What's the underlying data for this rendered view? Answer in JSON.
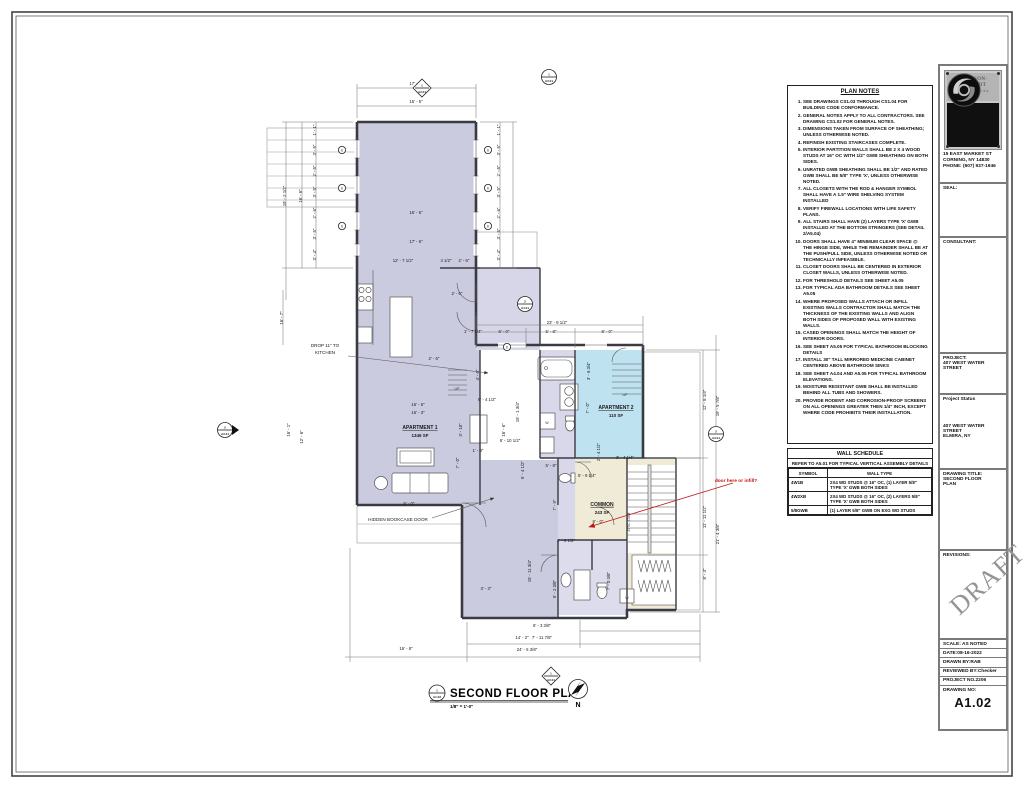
{
  "sheet": {
    "firm_name_line1": "JOHNSON-",
    "firm_name_line2": "SCHMIDT",
    "firm_sub": "ARCHITECTS",
    "firm_sub2": "PC",
    "address_line1": "15 EAST MARKET ST",
    "address_line2": "CORNING, NY 14830",
    "address_line3": "PHONE: (607) 937-1946",
    "seal_label": "SEAL:",
    "consultant_label": "CONSULTANT:",
    "project_label": "PROJECT:",
    "project_name": "407 WEST WATER STREET",
    "status_label": "Project Status",
    "project_address_line1": "407 WEST WATER",
    "project_address_line2": "STREET",
    "project_address_line3": "ELMIRA, NY",
    "drawing_title_label": "DRAWING TITLE:",
    "drawing_title_line1": "SECOND FLOOR",
    "drawing_title_line2": "PLAN",
    "revisions_label": "REVISIONS:",
    "draft_watermark": "DRAFT",
    "scale": "SCALE: AS NOTED",
    "date": "DATE:08-16-2022",
    "drawn_by": "DRAWN BY:RAB",
    "reviewed_by": "REVIEWED BY:Checker",
    "project_no": "PROJECT NO.2206",
    "drawing_no_label": "DRAWING NO:",
    "drawing_no": "A1.02"
  },
  "plan_notes": {
    "title": "PLAN NOTES",
    "items": [
      "SEE DRAWINGS CS1.03 THROUGH CS1.04 FOR BUILDING CODE CONFORMANCE.",
      "GENERAL NOTES APPLY TO ALL CONTRACTORS. SEE DRAWING CS1.02 FOR GENERAL NOTES.",
      "DIMENSIONS TAKEN FROM SURFACE OF SHEATHING; UNLESS OTHERWISE NOTED.",
      "REFINISH EXISTING STAIRCASES COMPLETE.",
      "INTERIOR PARTITION WALLS SHALL BE 2 X 4 WOOD STUDS AT 16\" OC WITH 1/2\" GWB SHEATHING ON BOTH SIDES.",
      "UNRATED GWB SHEATHING SHALL BE 1/2\" AND RATED GWB SHALL BE 5/8\" TYPE 'X', UNLESS OTHERWISE NOTED.",
      "ALL CLOSETS WITH THE ROD & HANGER SYMBOL SHALL HAVE A 1.5\" WIRE SHELVING SYSTEM INSTALLED",
      "VERIFY FIREWALL LOCATIONS WITH LIFE SAFETY PLANS.",
      "ALL STAIRS SHALL HAVE (2) LAYERS TYPE 'X' GWB INSTALLED AT THE BOTTOM STRINGERS (SEE DETAIL 2/A5.04)",
      "DOORS SHALL HAVE 4\" MINIMUM CLEAR SPACE @ THE HINGE SIDE, WHILE THE REMAINDER SHALL BE AT THE PUSH/PULL SIDE, UNLESS OTHERWISE NOTED OR TECHNICALLY INFEASIBLE.",
      "CLOSET DOORS SHALL BE CENTERED IN EXTERIOR CLOSET WALLS, UNLESS OTHERWISE NOTED.",
      "FOR THRESHOLD DETAILS SEE SHEET A5.05",
      "FOR TYPICAL ADA BATHROOM DETAILS SEE SHEET A5.05",
      "WHERE PROPOSED WALLS ATTACH OR INFILL EXISTING WALLS CONTRACTOR SHALL MATCH THE THICKNESS OF THE EXISTING WALLS AND ALIGN BOTH SIDES OF PROPOSED WALL WITH EXISTING WALLS.",
      "CASED OPENINGS SHALL MATCH THE HEIGHT OF INTERIOR DOORS.",
      "SEE SHEET A5.05 FOR TYPICAL BATHROOM BLOCKING DETAILS",
      "INSTALL 30\" TALL MIRRORED MEDICINE CABINET CENTERED ABOVE BATHROOM SINKS",
      "SEE SHEET A4.04 AND A5.05 FOR TYPICAL BATHROOM ELEVATIONS.",
      "MOISTURE RESISTANT GWB SHALL BE INSTALLED BEHIND ALL TUBS AND SHOWERS.",
      "PROVIDE RODENT AND CORROSION-PROOF SCREENS ON ALL OPENINGS GREATER THEN 1/4\" INCH, EXCEPT WHERE CODE PROHIBITS THEIR INSTALLATION."
    ]
  },
  "wall_schedule": {
    "title": "WALL SCHEDULE",
    "subtitle": "REFER TO A5.01 FOR TYPICAL VERTICAL ASSEMBLY DETAILS",
    "col_symbol": "SYMBOL",
    "col_walltype": "WALL TYPE",
    "rows": [
      {
        "symbol": "4W1B",
        "wall_type": "2X4 WD STUDS @ 16\" OC, (1) LAYER 5/8\" TYPE 'X' GWB BOTH SIDES"
      },
      {
        "symbol": "4W2XB",
        "wall_type": "2X4 WD STUDS @ 16\" OC, (2) LAYERS 5/8\" TYPE 'X' GWB BOTH SIDES"
      },
      {
        "symbol": "5/8GWB",
        "wall_type": "(1) LAYER 5/8\" GWB ON EXG WD STUDS"
      }
    ]
  },
  "plan_title": {
    "num": "1",
    "sheet": "A1.02",
    "title": "SECOND FLOOR PLAN",
    "scale": "1/8\" = 1'-0\"",
    "north": "N"
  },
  "rooms": [
    {
      "name": "APARTMENT 1",
      "area": "1346 SF"
    },
    {
      "name": "APARTMENT 2",
      "area": "110 SF"
    },
    {
      "name": "COMMON",
      "area": "243 SF"
    }
  ],
  "colors": {
    "room_lavender": "#cbcbe0",
    "room_blue": "#bfe2f1",
    "room_cream": "#f0ebd7",
    "wall": "#3a3a42",
    "redline": "#c11515"
  },
  "plan": {
    "texts": [
      {
        "x": 416,
        "y": 85,
        "t": "17' - 6\""
      },
      {
        "x": 416,
        "y": 103,
        "t": "16' - 5\""
      },
      {
        "x": 416,
        "y": 214,
        "t": "16' - 5\""
      },
      {
        "x": 416,
        "y": 243,
        "t": "17' - 6\""
      },
      {
        "x": 403,
        "y": 262,
        "t": "12' - 7 1/2\""
      },
      {
        "x": 446,
        "y": 262,
        "t": "4 1/2\""
      },
      {
        "x": 464,
        "y": 262,
        "t": "2' - 6\""
      },
      {
        "x": 286,
        "y": 196,
        "t": "19' - 2 1/2\"",
        "r": -90
      },
      {
        "x": 302,
        "y": 196,
        "t": "16' - 6\"",
        "r": -90
      },
      {
        "x": 316,
        "y": 130,
        "t": "1' - 1\"",
        "r": -90
      },
      {
        "x": 316,
        "y": 150,
        "t": "3' - 5\"",
        "r": -90
      },
      {
        "x": 316,
        "y": 171,
        "t": "2' - 6\"",
        "r": -90
      },
      {
        "x": 316,
        "y": 192,
        "t": "3' - 5\"",
        "r": -90
      },
      {
        "x": 316,
        "y": 213,
        "t": "2' - 6\"",
        "r": -90
      },
      {
        "x": 316,
        "y": 234,
        "t": "3' - 5\"",
        "r": -90
      },
      {
        "x": 316,
        "y": 255,
        "t": "3' - 4\"",
        "r": -90
      },
      {
        "x": 500,
        "y": 130,
        "t": "1' - 1\"",
        "r": -90
      },
      {
        "x": 500,
        "y": 150,
        "t": "3' - 5\"",
        "r": -90
      },
      {
        "x": 500,
        "y": 171,
        "t": "2' - 6\"",
        "r": -90
      },
      {
        "x": 500,
        "y": 192,
        "t": "3' - 5\"",
        "r": -90
      },
      {
        "x": 500,
        "y": 213,
        "t": "2' - 6\"",
        "r": -90
      },
      {
        "x": 500,
        "y": 234,
        "t": "3' - 5\"",
        "r": -90
      },
      {
        "x": 500,
        "y": 255,
        "t": "3' - 4\"",
        "r": -90
      },
      {
        "x": 283,
        "y": 318,
        "t": "16' - 7\"",
        "r": -90
      },
      {
        "x": 290,
        "y": 430,
        "t": "16' - 1\"",
        "r": -90
      },
      {
        "x": 303,
        "y": 437,
        "t": "12' - 6\"",
        "r": -90
      },
      {
        "x": 457,
        "y": 295,
        "t": "2' - 6\""
      },
      {
        "x": 434,
        "y": 360,
        "t": "2' - 6\""
      },
      {
        "x": 418,
        "y": 406,
        "t": "16' - 6\""
      },
      {
        "x": 418,
        "y": 414,
        "t": "16' - 3\""
      },
      {
        "x": 462,
        "y": 430,
        "t": "3' - 10\"",
        "r": -90
      },
      {
        "x": 459,
        "y": 463,
        "t": "7' - 0\"",
        "r": -90
      },
      {
        "x": 478,
        "y": 452,
        "t": "1' - 9\""
      },
      {
        "x": 487,
        "y": 401,
        "t": "8' - 4 1/2\""
      },
      {
        "x": 479,
        "y": 375,
        "t": "4' - 6\"",
        "r": -90
      },
      {
        "x": 505,
        "y": 430,
        "t": "16' - 6\"",
        "r": -90
      },
      {
        "x": 519,
        "y": 412,
        "t": "15' - 1 3/4\"",
        "r": -90
      },
      {
        "x": 510,
        "y": 442,
        "t": "6' - 10 1/2\""
      },
      {
        "x": 524,
        "y": 470,
        "t": "5' - 4 1/2\"",
        "r": -90
      },
      {
        "x": 409,
        "y": 505,
        "t": "5' - 0\""
      },
      {
        "x": 557,
        "y": 324,
        "t": "23' - 9 1/2\""
      },
      {
        "x": 473,
        "y": 333,
        "t": "1' - 7 1/4\""
      },
      {
        "x": 504,
        "y": 333,
        "t": "6' - 0\""
      },
      {
        "x": 551,
        "y": 333,
        "t": "5' - 8\""
      },
      {
        "x": 607,
        "y": 333,
        "t": "8' - 0\""
      },
      {
        "x": 590,
        "y": 371,
        "t": "3' - 6 3/4\"",
        "r": -90
      },
      {
        "x": 589,
        "y": 408,
        "t": "7' - 0\"",
        "r": -90
      },
      {
        "x": 625,
        "y": 459,
        "t": "3' - 4 1/4\""
      },
      {
        "x": 600,
        "y": 452,
        "t": "2' - 4 1/2\"",
        "r": -90
      },
      {
        "x": 587,
        "y": 477,
        "t": "5' - 9 1/4\""
      },
      {
        "x": 551,
        "y": 467,
        "t": "5' - 8\""
      },
      {
        "x": 556,
        "y": 505,
        "t": "7' - 9\"",
        "r": -90
      },
      {
        "x": 598,
        "y": 523,
        "t": "8' - 0\""
      },
      {
        "x": 566,
        "y": 542,
        "t": "1' - 9 1/2\""
      },
      {
        "x": 531,
        "y": 571,
        "t": "15' - 11 3/4\"",
        "r": -90
      },
      {
        "x": 556,
        "y": 589,
        "t": "5' - 2 3/8\"",
        "r": -90
      },
      {
        "x": 610,
        "y": 581,
        "t": "7' - 0 3/8\"",
        "r": -90
      },
      {
        "x": 486,
        "y": 590,
        "t": "3' - 3\""
      },
      {
        "x": 406,
        "y": 650,
        "t": "16' - 8\""
      },
      {
        "x": 522,
        "y": 639,
        "t": "14' - 2\""
      },
      {
        "x": 527,
        "y": 651,
        "t": "24' - 6 3/8\""
      },
      {
        "x": 542,
        "y": 627,
        "t": "6' - 3 3/8\""
      },
      {
        "x": 542,
        "y": 639,
        "t": "7' - 11 7/8\""
      },
      {
        "x": 706,
        "y": 517,
        "t": "11' - 11 1/2\"",
        "r": -90
      },
      {
        "x": 719,
        "y": 534,
        "t": "21' - 4 3/8\"",
        "r": -90
      },
      {
        "x": 706,
        "y": 574,
        "t": "8' - 4\"",
        "r": -90
      },
      {
        "x": 706,
        "y": 400,
        "t": "12' - 8 1/4\"",
        "r": -90
      },
      {
        "x": 719,
        "y": 406,
        "t": "19' - 5 7/8\"",
        "r": -90
      },
      {
        "x": 420,
        "y": 429,
        "t": "APARTMENT 1",
        "cls": "room"
      },
      {
        "x": 420,
        "y": 437,
        "t": "1346 SF",
        "cls": "area"
      },
      {
        "x": 616,
        "y": 409,
        "t": "APARTMENT 2",
        "cls": "room"
      },
      {
        "x": 616,
        "y": 417,
        "t": "110 SF",
        "cls": "area"
      },
      {
        "x": 602,
        "y": 506,
        "t": "COMMON",
        "cls": "room"
      },
      {
        "x": 602,
        "y": 514,
        "t": "243 SF",
        "cls": "area"
      },
      {
        "x": 325,
        "y": 347,
        "t": "DROP 11\" TO",
        "cls": "ann"
      },
      {
        "x": 325,
        "y": 354,
        "t": "KITCHEN",
        "cls": "ann"
      },
      {
        "x": 398,
        "y": 521,
        "t": "HIDDEN BOOKCASE DOOR",
        "cls": "ann"
      },
      {
        "x": 736,
        "y": 482,
        "t": "door here or infill?",
        "cls": "red",
        "anchor": "start"
      },
      {
        "x": 457,
        "y": 390,
        "t": "UP",
        "cls": "fix"
      },
      {
        "x": 625,
        "y": 396,
        "t": "UP",
        "cls": "fix"
      },
      {
        "x": 547,
        "y": 424,
        "t": "W",
        "cls": "fix"
      },
      {
        "x": 627,
        "y": 599,
        "t": "W",
        "cls": "fix"
      },
      {
        "x": 630,
        "y": 522,
        "t": "ATTIC STAIR",
        "cls": "tiny",
        "r": -90
      }
    ],
    "markers": [
      {
        "x": 422,
        "y": 88,
        "shape": "diamond",
        "a": "1",
        "b": "A3.01"
      },
      {
        "x": 549,
        "y": 77,
        "shape": "circle",
        "a": "1",
        "b": "A3.01"
      },
      {
        "x": 225,
        "y": 430,
        "shape": "circle-right",
        "a": "2",
        "b": "A3.01"
      },
      {
        "x": 716,
        "y": 434,
        "shape": "circle",
        "a": "3",
        "b": "A3.01"
      },
      {
        "x": 525,
        "y": 304,
        "shape": "circle",
        "a": "2",
        "b": "A4.01"
      },
      {
        "x": 551,
        "y": 676,
        "shape": "diamond",
        "a": "1",
        "b": "A3.01"
      },
      {
        "x": 507,
        "y": 347,
        "shape": "tag",
        "a": "6"
      },
      {
        "x": 342,
        "y": 150,
        "shape": "tag",
        "a": "6"
      },
      {
        "x": 342,
        "y": 188,
        "shape": "tag",
        "a": "6"
      },
      {
        "x": 342,
        "y": 226,
        "shape": "tag",
        "a": "6"
      },
      {
        "x": 488,
        "y": 150,
        "shape": "tag",
        "a": "6"
      },
      {
        "x": 488,
        "y": 188,
        "shape": "tag",
        "a": "6"
      },
      {
        "x": 488,
        "y": 226,
        "shape": "tag",
        "a": "6"
      }
    ]
  }
}
